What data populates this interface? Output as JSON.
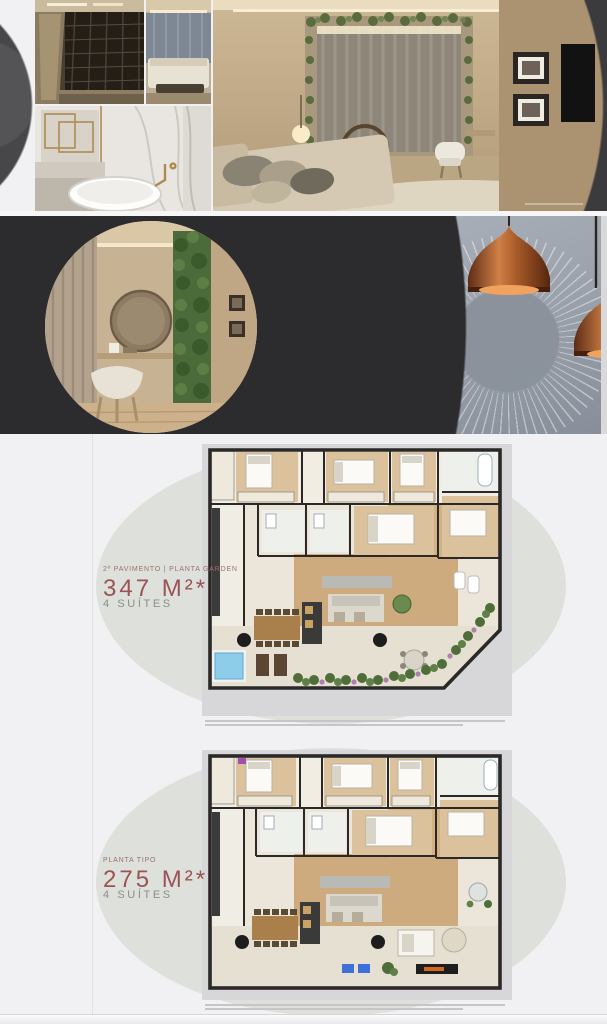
{
  "plans": [
    {
      "badge": "2º PAVIMENTO | PLANTA GARDEN",
      "area": "347 M²*",
      "suites": "4 SUÍTES"
    },
    {
      "badge": "PLANTA TIPO",
      "area": "275 M²*",
      "suites": "4 SUÍTES"
    }
  ],
  "gallery": {
    "top": [
      "walk-in-closet",
      "suite-bed",
      "marble-bathroom-tub",
      "master-bedroom"
    ],
    "middle": [
      "vanity-green-wall",
      "copper-pendant-lamps"
    ]
  },
  "colors": {
    "accent_maroon": "#9b5356",
    "badge_maroon": "#9c6f6f",
    "suites_gray": "#8c8c8a",
    "sage_arc": "#dee1db",
    "charcoal": "#2c2c2e",
    "copper": "#c07a45",
    "pool_blue": "#8ecdea",
    "page_background": "#f1f1f3"
  }
}
